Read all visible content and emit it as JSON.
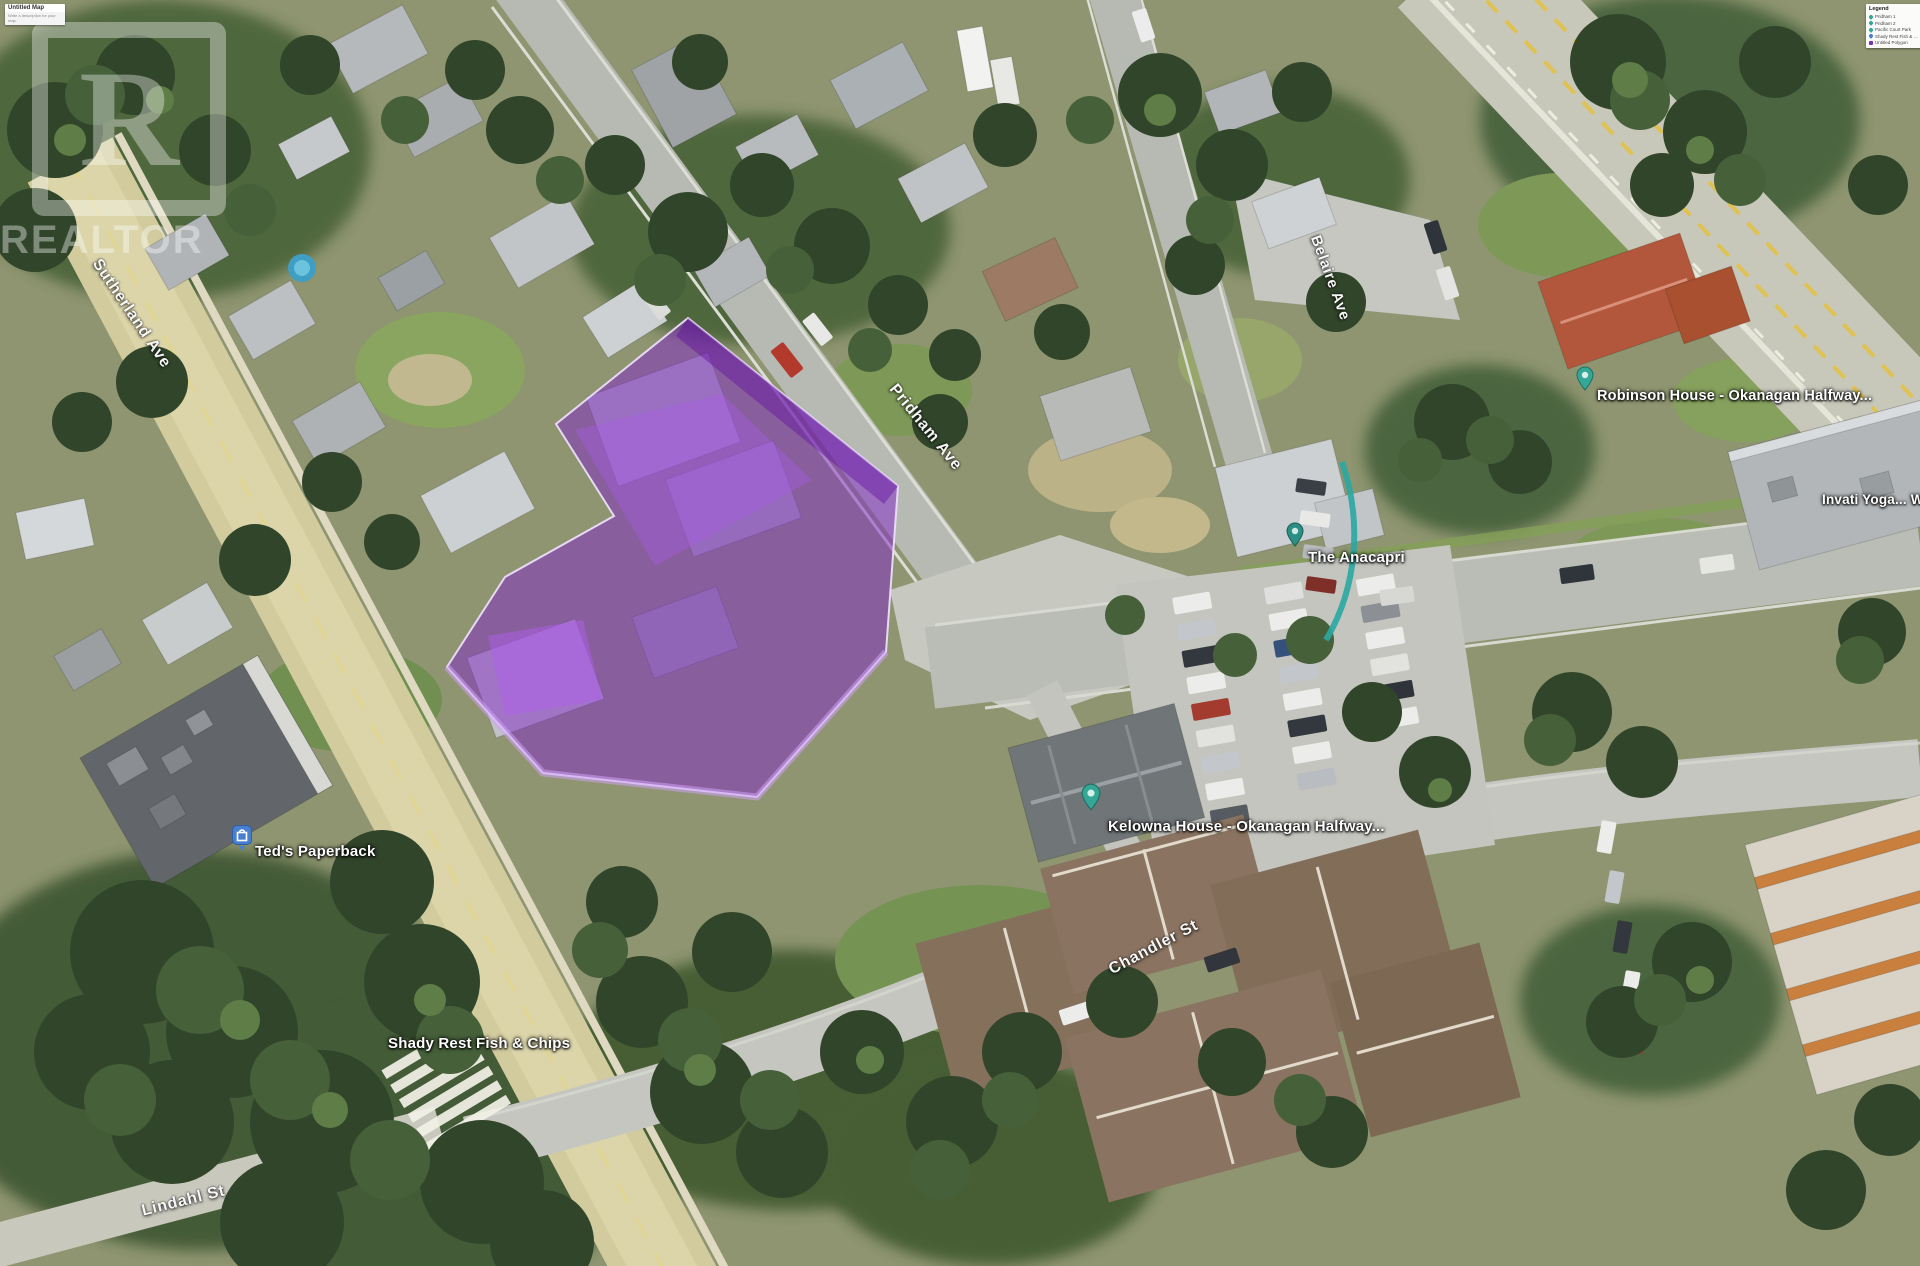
{
  "app": {
    "map_title": "Untitled Map",
    "map_subtitle": "Write a description for your map."
  },
  "watermark": {
    "letter": "R",
    "word": "REALTOR"
  },
  "legend": {
    "title": "Legend",
    "items": [
      {
        "label": "Pridham 1",
        "icon": "teal-pin"
      },
      {
        "label": "Pridham 2",
        "icon": "teal-pin"
      },
      {
        "label": "Pacific Court Park",
        "icon": "teal-pin"
      },
      {
        "label": "Shady Rest Fish & Chips",
        "icon": "blue-pin"
      },
      {
        "label": "Untitled Polygon",
        "icon": "purple-square"
      }
    ]
  },
  "streets": {
    "sutherland": "Sutherland Ave",
    "pridham": "Pridham Ave",
    "belaire": "Belaire Ave",
    "chandler": "Chandler St",
    "lindahl": "Lindahl St"
  },
  "places": {
    "teds": "Ted's Paperback",
    "shady": "Shady Rest Fish & Chips",
    "robinson": "Robinson House - Okanagan Halfway...",
    "anacapri": "The Anacapri",
    "kelowna_house": "Kelowna House - Okanagan Halfway...",
    "invati": "Invati Yoga... W"
  },
  "colors": {
    "parcel_purple": "#8c2cc8",
    "pin_teal": "#35a796",
    "pin_blue": "#4a7fd0",
    "road_beige": "#d2cb9e",
    "highway_yellow": "#dfc252"
  }
}
